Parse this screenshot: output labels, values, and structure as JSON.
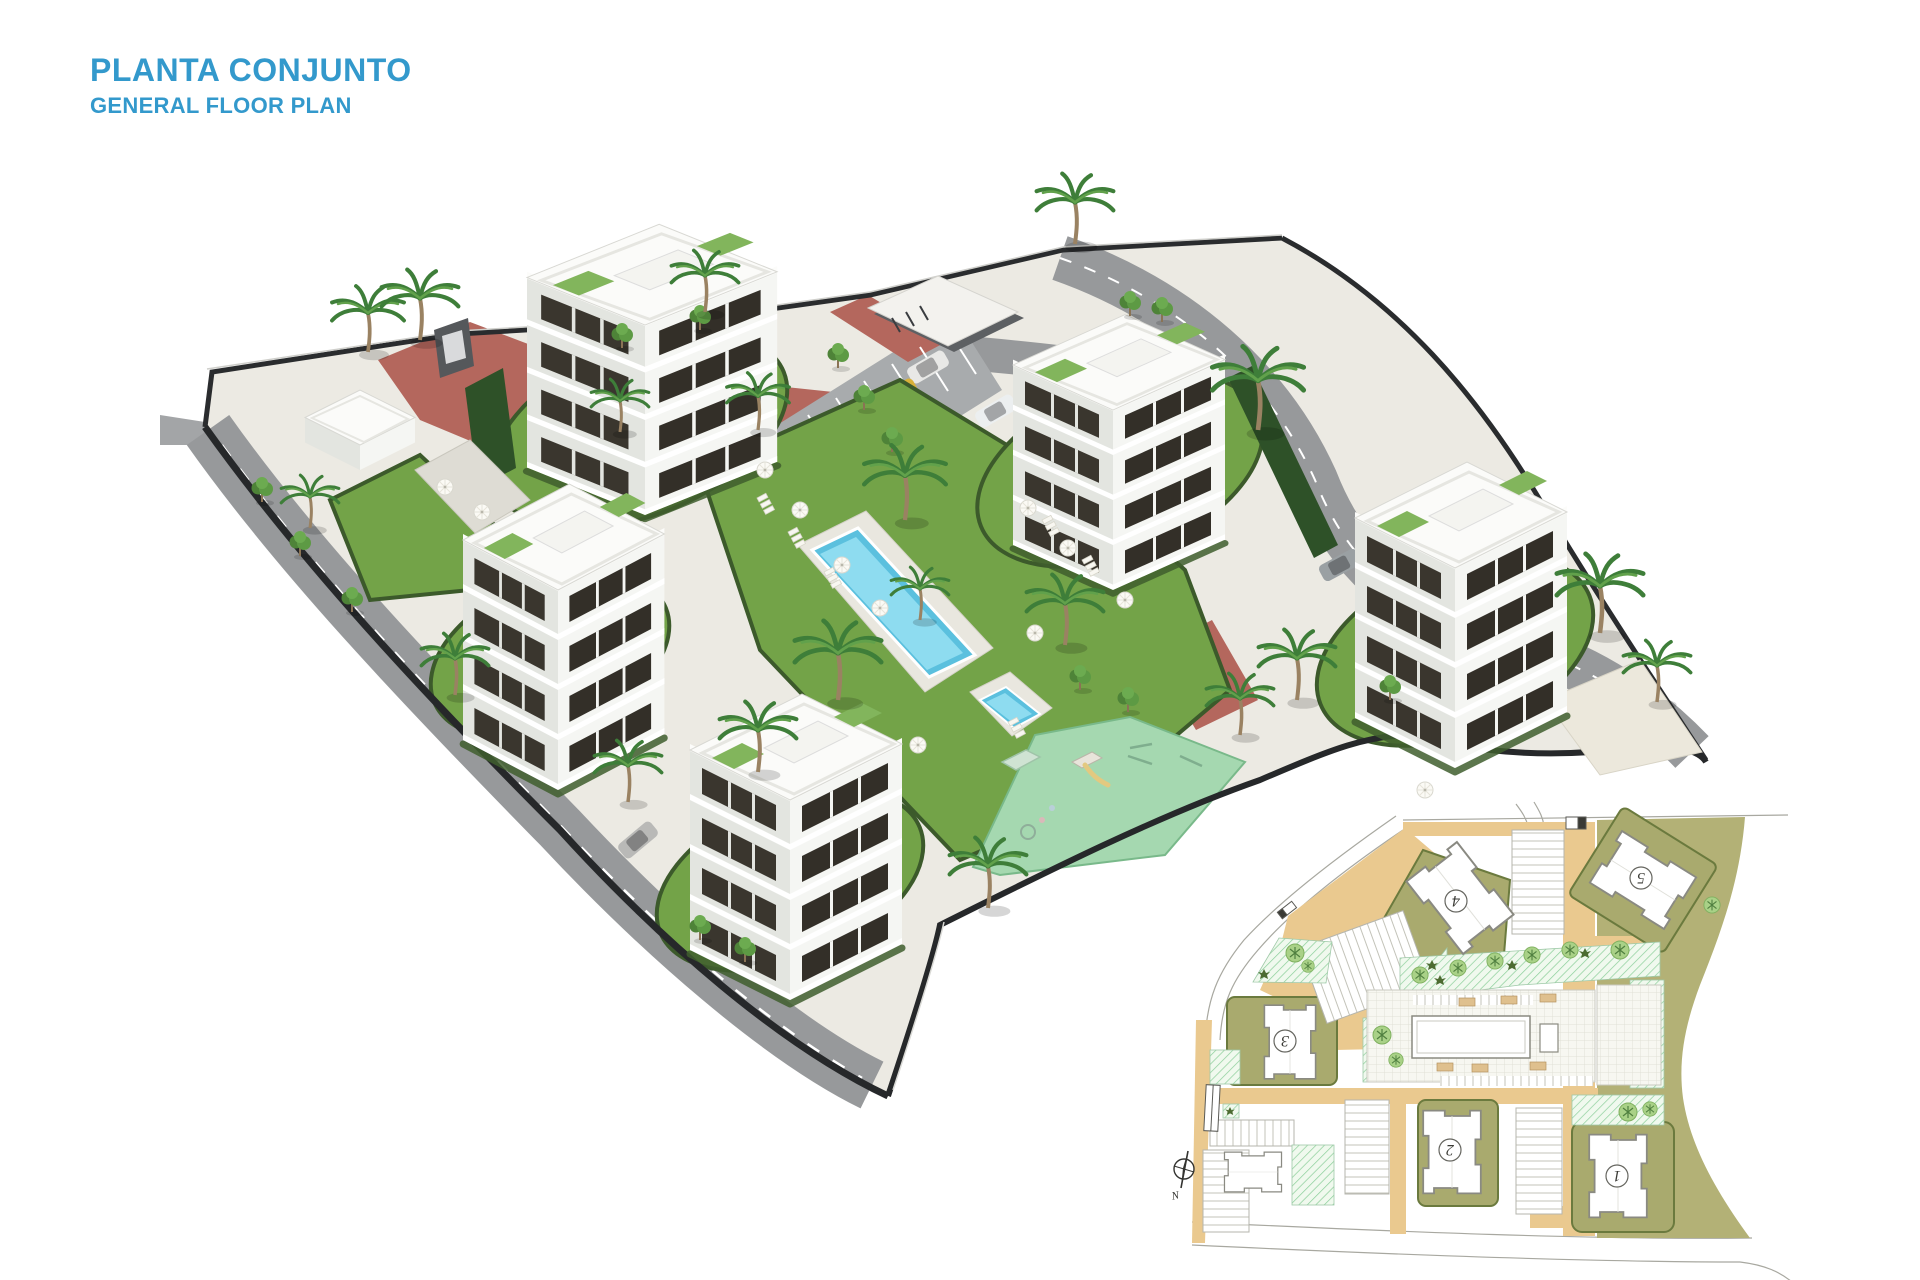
{
  "header": {
    "title": "PLANTA CONJUNTO",
    "subtitle": "GENERAL FLOOR PLAN",
    "accent_color": "#3399cc"
  },
  "render3d": {
    "icons": {
      "palm": "palm-tree-icon",
      "tree": "tree-icon",
      "umbrella": "parasol-icon",
      "car": "car-icon",
      "sunbeds": "sunbeds-icon"
    },
    "palette": {
      "lawn": "#73a348",
      "hedge": "#3c5a2b",
      "road": "#97999b",
      "road_marking": "#ffffff",
      "boundary_wall": "#26282a",
      "brick_path": "#b4675d",
      "walkway": "#eceae3",
      "building_face": "#f5f6f3",
      "building_side": "#e3e5e0",
      "window": "#332f28",
      "roof": "#fbfbf9",
      "roof_terrace_green": "#82b55c",
      "pool_water": "#5bc0de",
      "pool_water_light": "#8edcf0",
      "pool_deck": "#e9e7df",
      "playground": "#a5d8b0",
      "sand_deck": "#ece8dc",
      "car_colors": [
        "#e8e8e6",
        "#d8b13a",
        "#3a3d40",
        "#a9adb0",
        "#a32638",
        "#3f7f8c",
        "#2c2f33",
        "#eceff0"
      ]
    }
  },
  "site_plan": {
    "buildings": [
      {
        "label": "1"
      },
      {
        "label": "2"
      },
      {
        "label": "3"
      },
      {
        "label": "4"
      },
      {
        "label": "5"
      }
    ],
    "compass": {
      "label": "N",
      "icon": "compass-icon"
    },
    "palette": {
      "road_tan": "#eac98f",
      "terrain_olive": "#b3b176",
      "plot_olive": "#a9aa6e",
      "hedge_line": "#6b7a3e",
      "garden_hatch": "#8ccf9b",
      "building_fill": "#ffffff",
      "outline": "#8a8a82",
      "paving_grid": "#e0e0d6"
    }
  }
}
